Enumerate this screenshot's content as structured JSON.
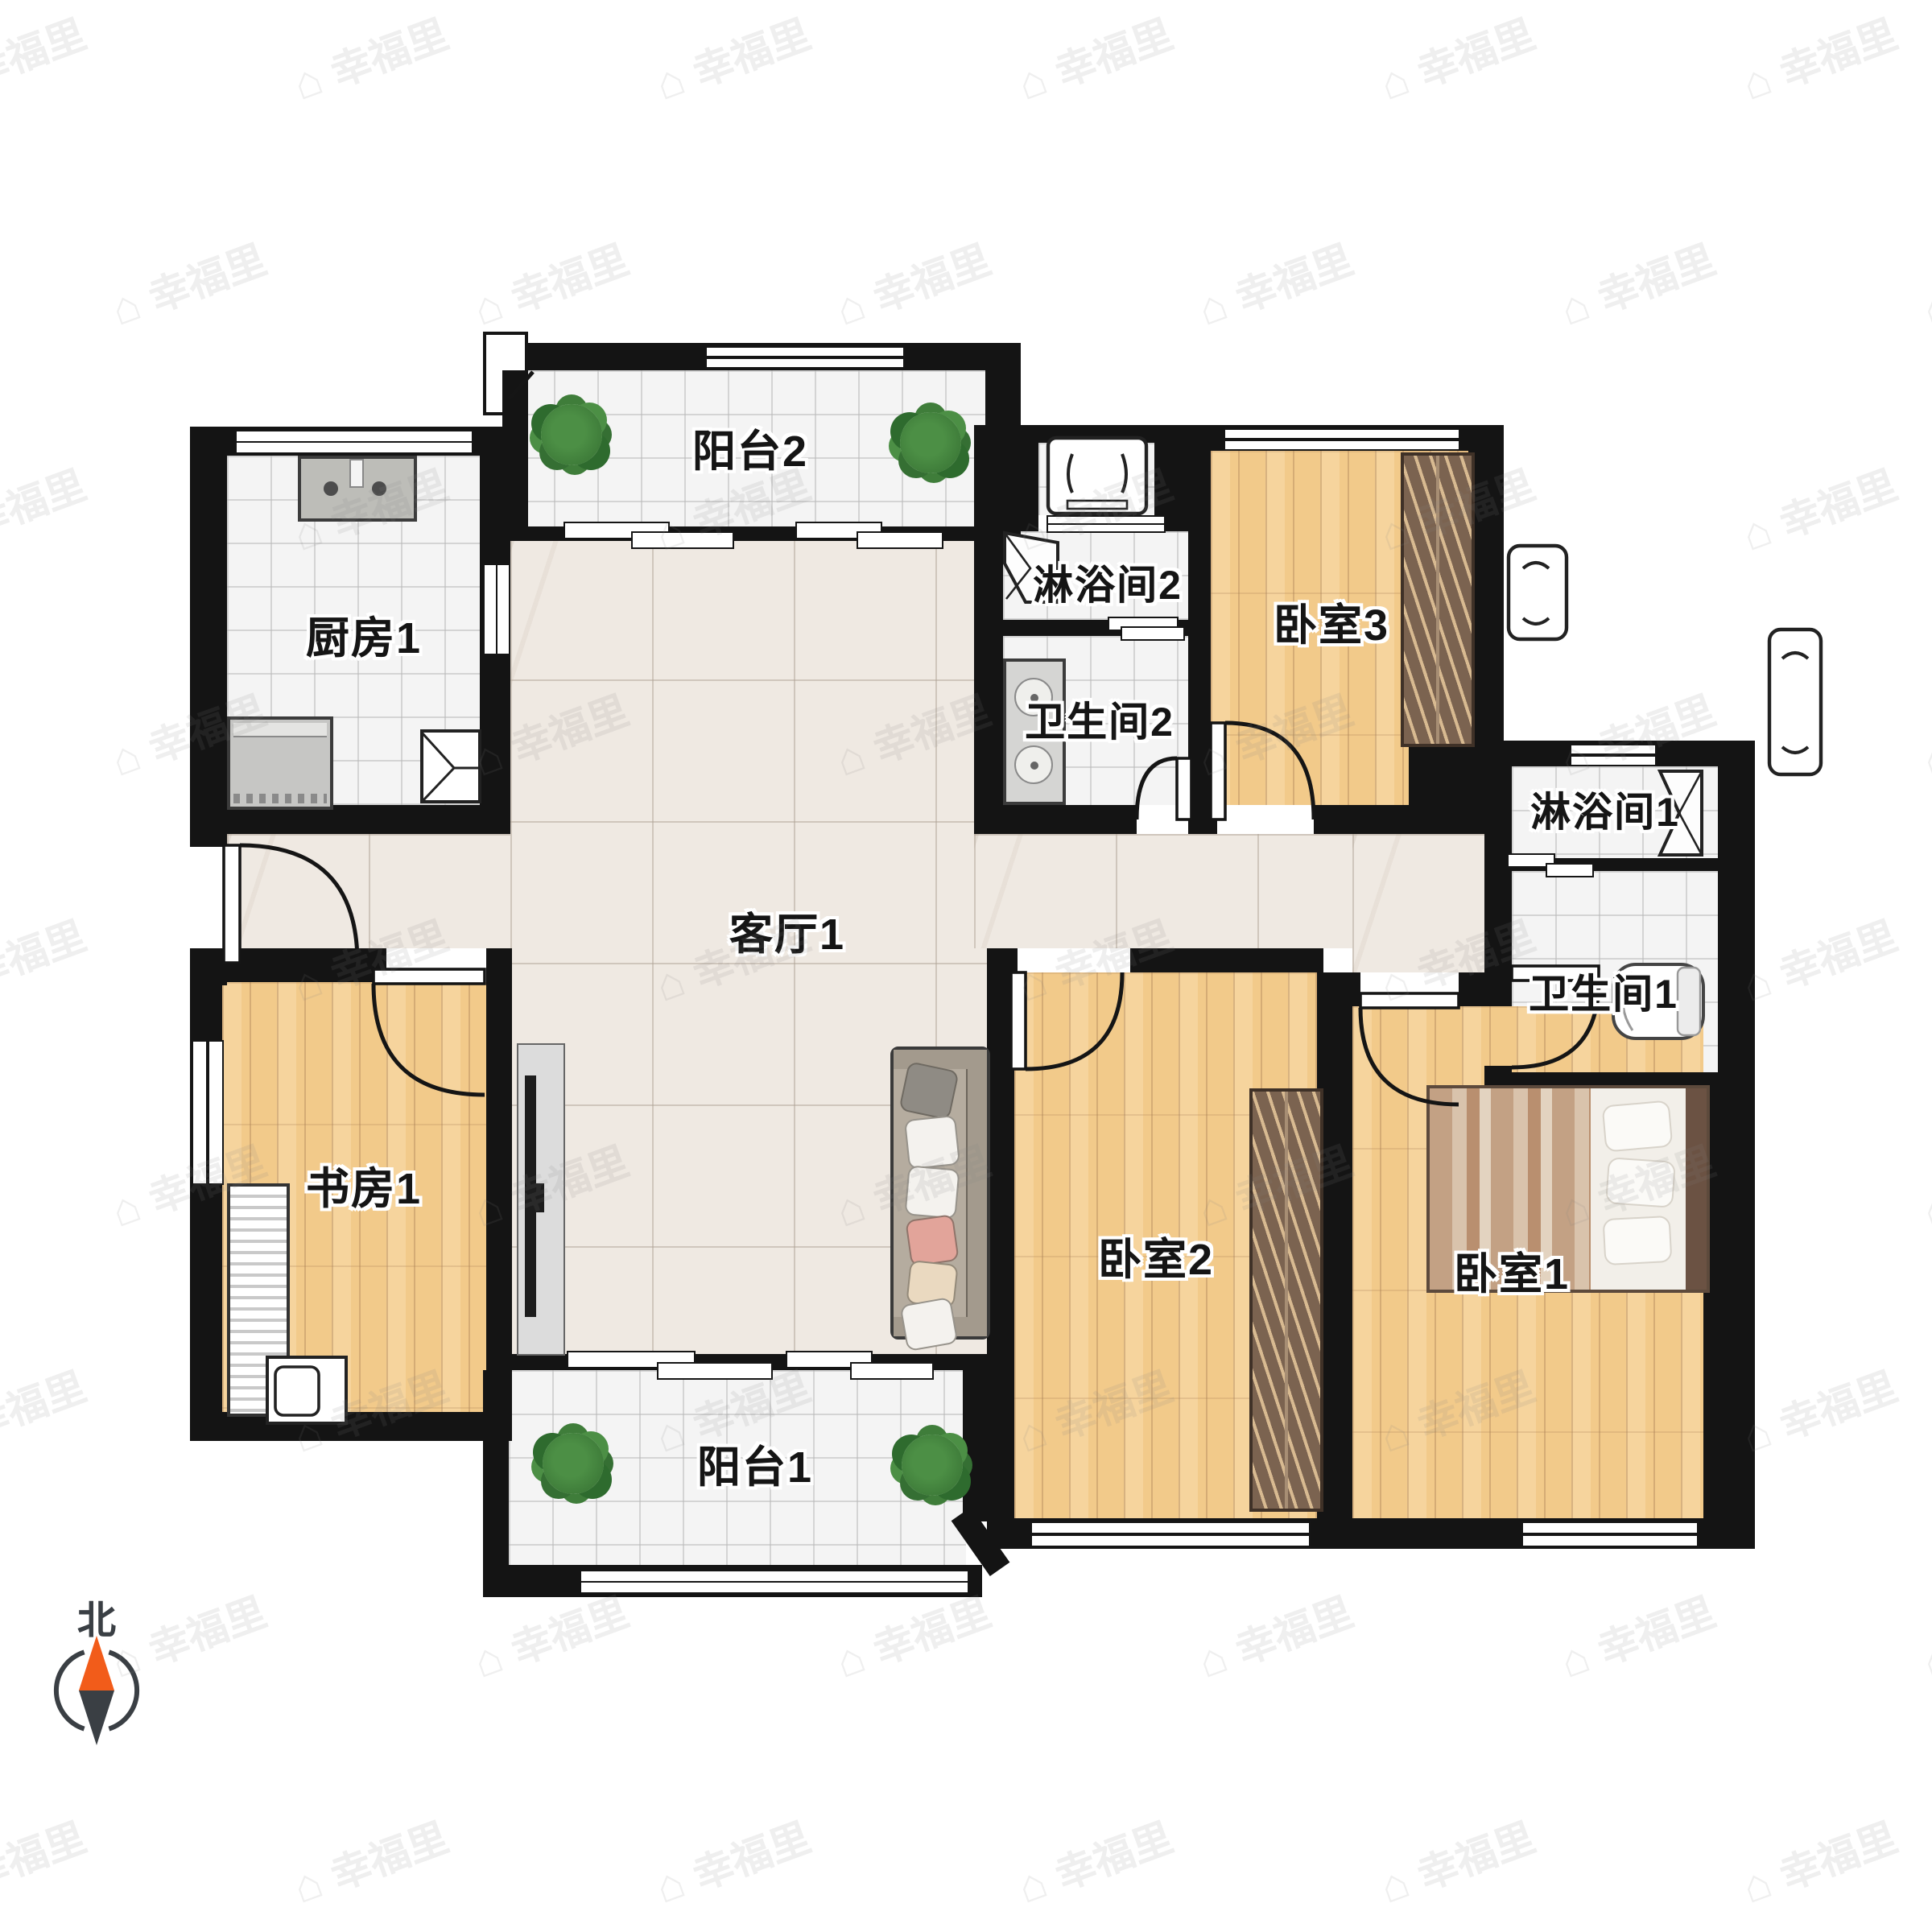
{
  "page": {
    "type": "residential-floor-plan"
  },
  "compass": {
    "north_label": "北"
  },
  "watermark": {
    "text": "幸福里"
  },
  "rooms": {
    "balcony2": "阳台2",
    "kitchen1": "厨房1",
    "shower2": "淋浴间2",
    "bathroom2": "卫生间2",
    "bedroom3": "卧室3",
    "shower1": "淋浴间1",
    "bathroom1": "卫生间1",
    "living1": "客厅1",
    "study1": "书房1",
    "bedroom2": "卧室2",
    "bedroom1": "卧室1",
    "balcony1": "阳台1"
  },
  "colors": {
    "wall": "#141414",
    "wood": "#f2ca8a",
    "marble": "#efe9e2",
    "tile": "#f4f4f4",
    "wardrobe": "#7b6350",
    "plant": "#3f7d3a",
    "compass-north": "#f25c1a",
    "compass-south": "#3a3f44"
  }
}
